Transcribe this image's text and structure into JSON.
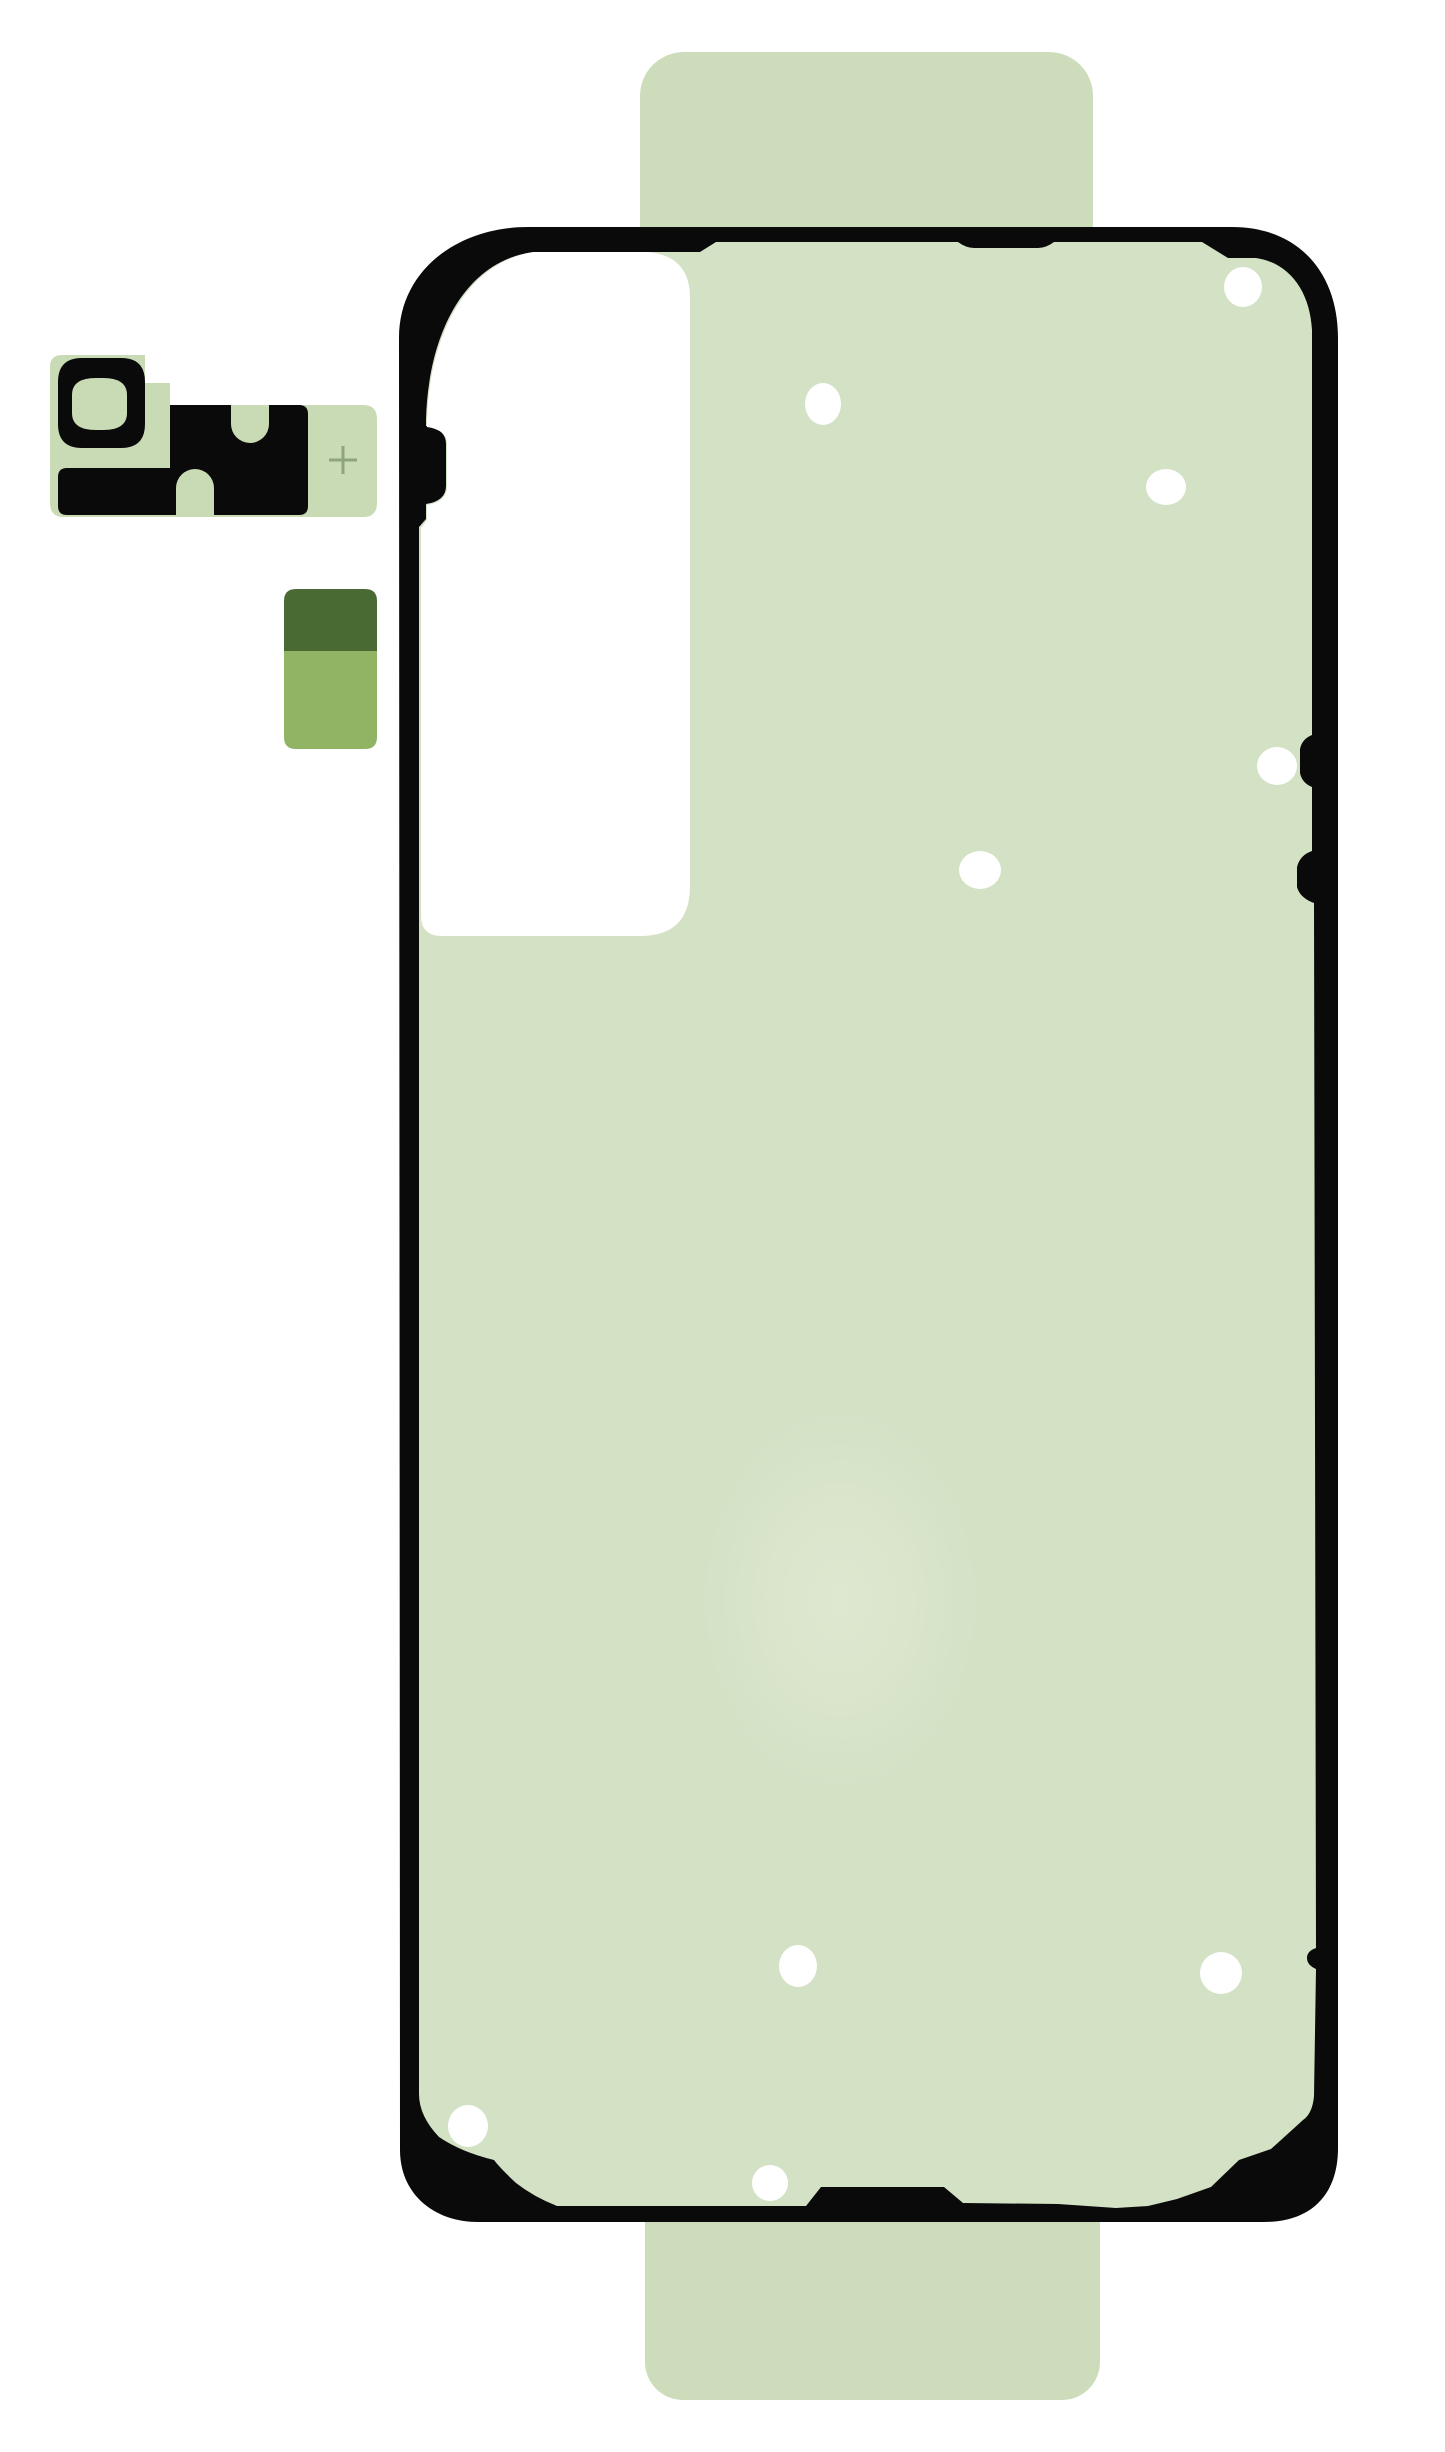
{
  "product": {
    "subject": "smartphone-back-cover-adhesive-kit",
    "pieces": [
      "main-back-cover-adhesive-sheet",
      "camera-bezel-adhesive",
      "pull-tab-sticker"
    ]
  },
  "colors": {
    "background": "#ffffff",
    "outline_black": "#0a0a0a",
    "sheet_green": "#d3e1c5",
    "liner_tab_green": "#cdddbb",
    "camera_liner_green": "#c9dbb4",
    "cutout_white": "#ffffff",
    "hole_white": "#ffffff",
    "pull_tab_dark_green": "#496b33",
    "pull_tab_light_green": "#90b464",
    "plus_mark_green": "#8fa37d",
    "watermark_green": "#e0e9d2"
  },
  "adhesive_sheet": {
    "hole_count": 9,
    "screw_hole_dots": [
      {
        "cx": 823,
        "cy": 404,
        "rx": 18,
        "ry": 21
      },
      {
        "cx": 1243,
        "cy": 287,
        "rx": 19,
        "ry": 20
      },
      {
        "cx": 1166,
        "cy": 487,
        "rx": 20,
        "ry": 18
      },
      {
        "cx": 980,
        "cy": 870,
        "rx": 21,
        "ry": 19
      },
      {
        "cx": 1277,
        "cy": 766,
        "rx": 20,
        "ry": 19
      },
      {
        "cx": 798,
        "cy": 1966,
        "rx": 19,
        "ry": 21
      },
      {
        "cx": 1221,
        "cy": 1973,
        "rx": 21,
        "ry": 21
      },
      {
        "cx": 468,
        "cy": 2126,
        "rx": 20,
        "ry": 21
      },
      {
        "cx": 770,
        "cy": 2183,
        "rx": 18,
        "ry": 18
      }
    ]
  },
  "camera_adhesive": {
    "plus_mark": "+",
    "keyhole_count": 2
  }
}
